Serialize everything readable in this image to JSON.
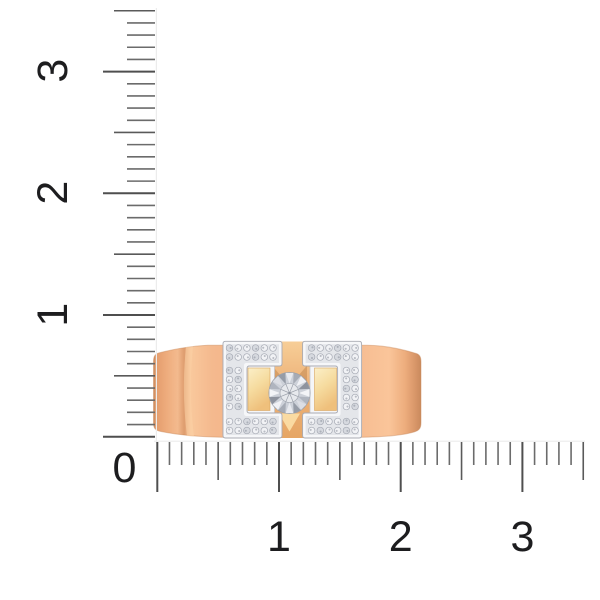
{
  "page": {
    "background": "#ffffff",
    "subject": "rose-gold ring with round center diamond and two pave-set white-gold brackets, shown to scale against rulers"
  },
  "measurement": {
    "vertical": {
      "min": 0,
      "max": 3.5,
      "step": 0.1,
      "labels": [
        {
          "text": "3",
          "value": 3
        },
        {
          "text": "2",
          "value": 2
        },
        {
          "text": "1",
          "value": 1
        }
      ]
    },
    "horizontal": {
      "min": 0,
      "max": 3.5,
      "step": 0.1,
      "labels": [
        {
          "text": "1",
          "value": 1
        },
        {
          "text": "2",
          "value": 2
        },
        {
          "text": "3",
          "value": 3
        }
      ]
    },
    "origin_label": {
      "text": "0"
    }
  },
  "colors": {
    "background": "#ffffff",
    "tick": "#6b6b6b",
    "tick_half": "#5a5a5a",
    "tick_major": "#4f4f4f",
    "baseline": "#ececec",
    "label": "#1d1d1f",
    "gold_main": "#F2B083",
    "gold_light": "#F9C89C",
    "gold_dark": "#DB9765",
    "gold_rim": "#CE8A5B",
    "gold_cream": "#FBEFC8",
    "gold_cream_deep": "#EFC07C",
    "silver_base": "#E9EAEE",
    "silver_inner": "#E0E2E7",
    "silver_white": "#F8F9FB",
    "stone_fill": "#F1F2F5",
    "stone_alt": "#D6D9DF",
    "stone_stroke": "#A6AAB4",
    "stone_dark": "#8A909B",
    "diamond_base": "#CDD1D9",
    "diamond_shades": [
      "#F3F4F7",
      "#B0B5BF",
      "#DCDEE4",
      "#969CA7",
      "#E8EAEF",
      "#A6ABB5",
      "#F0F1F5",
      "#8E939E"
    ],
    "diamond_table": "#E7E9ED",
    "diamond_line": "#9BA0AA"
  }
}
